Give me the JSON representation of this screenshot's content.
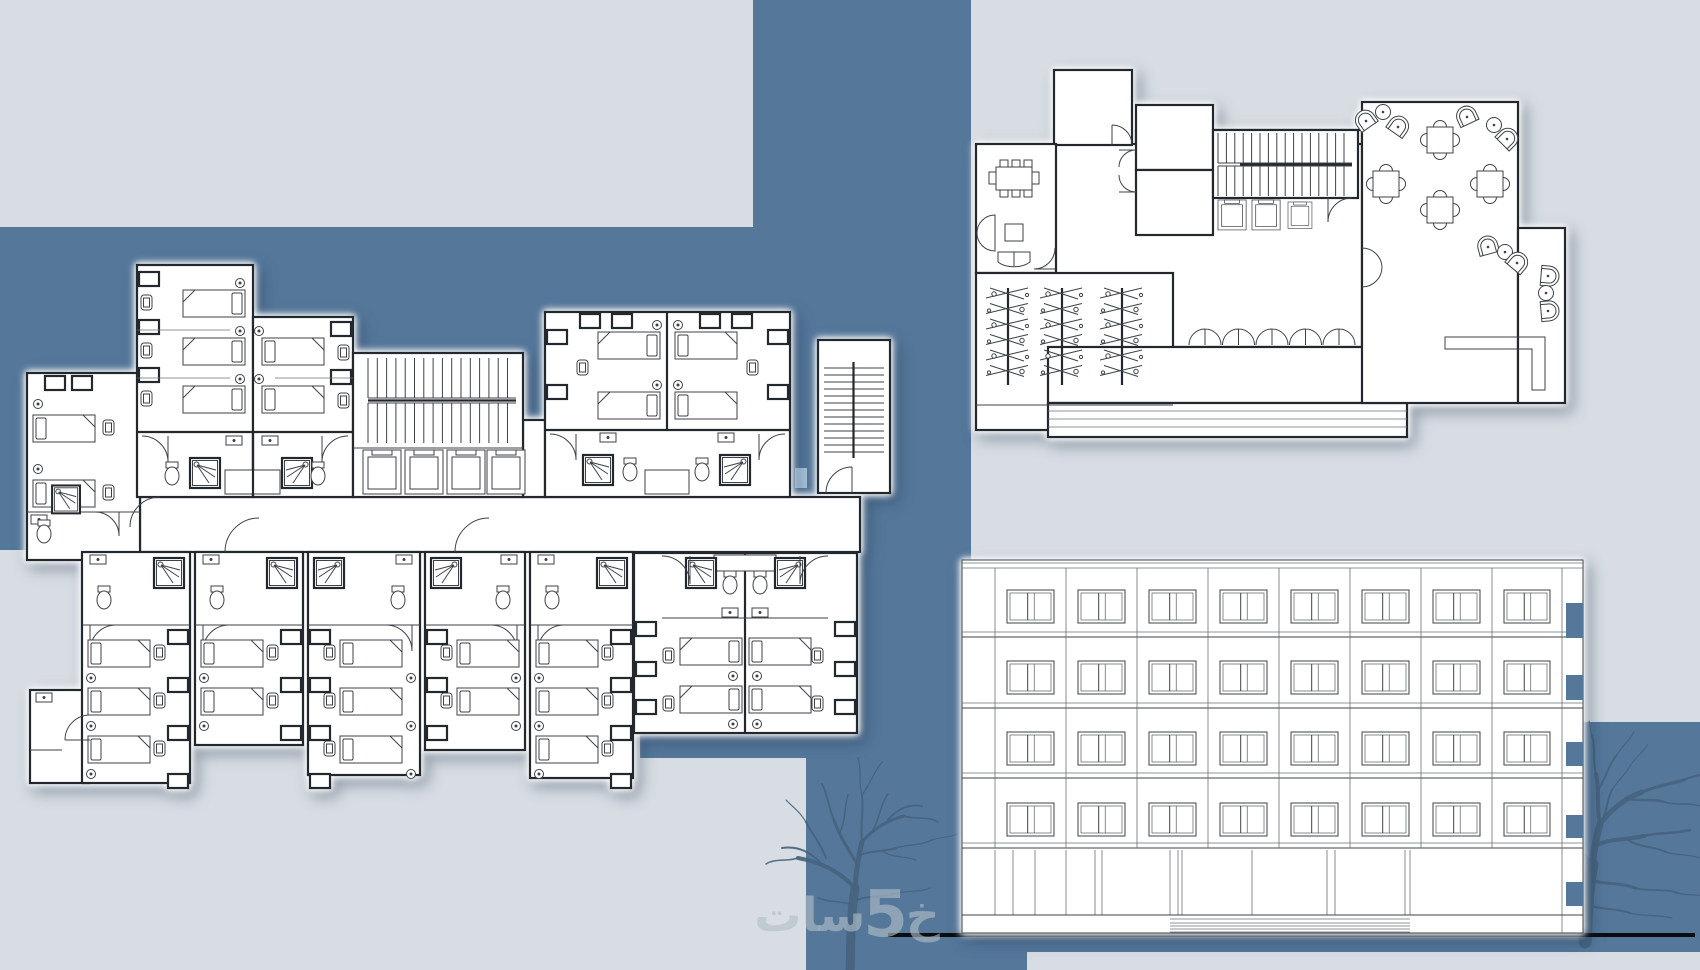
{
  "canvas": {
    "width": 1700,
    "height": 970
  },
  "colors": {
    "background_dark": "#54779A",
    "panel_light": "#D7DDE3",
    "accent_patch": "#A9C7DC",
    "paper_white": "#FFFFFF",
    "line_dark": "#3C4248",
    "wall_dark": "#23282E",
    "tree_silhouette": "#47637E",
    "ground_line": "#0B0C0D",
    "watermark_text": "rgba(178,190,199,0.62)"
  },
  "watermark": {
    "prefix": "خ",
    "digit": "5",
    "suffix": "سات"
  },
  "background": {
    "light_rects": [
      {
        "x": 0,
        "y": 0,
        "w": 753,
        "h": 227
      },
      {
        "x": 971,
        "y": 0,
        "w": 729,
        "h": 722
      },
      {
        "x": 0,
        "y": 550,
        "w": 640,
        "h": 420
      },
      {
        "x": 628,
        "y": 758,
        "w": 178,
        "h": 212
      },
      {
        "x": 1027,
        "y": 952,
        "w": 673,
        "h": 18
      }
    ],
    "accent_patch": {
      "x": 795,
      "y": 468,
      "w": 12,
      "h": 20
    },
    "ground_line": {
      "x1": 888,
      "x2": 1695,
      "y": 933,
      "h": 4
    }
  },
  "drawings": {
    "typical_floor_plan": {
      "name": "typical-floor-plan",
      "lower_units": [
        {
          "x": 82,
          "w": 108,
          "bottom": 783,
          "beds": 3,
          "mirror": false
        },
        {
          "x": 195,
          "w": 108,
          "bottom": 745,
          "beds": 2,
          "mirror": false
        },
        {
          "x": 308,
          "w": 112,
          "bottom": 775,
          "beds": 3,
          "mirror": true
        },
        {
          "x": 425,
          "w": 100,
          "bottom": 750,
          "beds": 2,
          "mirror": true
        },
        {
          "x": 530,
          "w": 103,
          "bottom": 778,
          "beds": 3,
          "mirror": false
        }
      ],
      "main_stair": {
        "x1": 368,
        "x2": 516,
        "runs": [
          [
            358,
            398
          ],
          [
            403,
            443
          ]
        ],
        "step": 9.3,
        "rail_y": 400.5
      },
      "tower_stair": {
        "x1": 824,
        "x2": 884,
        "y1": 368,
        "y2": 458,
        "step": 7,
        "rail_x": 853.5
      }
    },
    "ground_floor_plan": {
      "name": "ground-floor-plan",
      "lobby_stair": {
        "x1": 1218,
        "x2": 1352,
        "runs": [
          [
            133,
            163
          ],
          [
            166,
            196
          ]
        ],
        "step": 8.4,
        "rail_y": 164.5,
        "rail_x1": 1240
      },
      "plants": {
        "columns": [
          1008,
          1062,
          1122
        ],
        "top": 292,
        "rows": 6,
        "dy": 15.5
      },
      "colonnade": {
        "x0": 1189,
        "count": 5,
        "pitch": 33.5,
        "y": 345,
        "r": 16
      },
      "restaurant_tables": [
        [
          1440,
          140
        ],
        [
          1386,
          184
        ],
        [
          1490,
          184
        ],
        [
          1440,
          210
        ]
      ],
      "lounge_clusters": [
        {
          "items": [
            {
              "t": "chair",
              "x": 1366,
              "y": 121,
              "r": -35
            },
            {
              "t": "table",
              "x": 1383,
              "y": 112
            },
            {
              "t": "chair",
              "x": 1398,
              "y": 127,
              "r": 35
            }
          ]
        },
        {
          "items": [
            {
              "t": "chair",
              "x": 1467,
              "y": 117,
              "r": -25
            },
            {
              "t": "table",
              "x": 1494,
              "y": 125
            },
            {
              "t": "chair",
              "x": 1507,
              "y": 139,
              "r": 45
            }
          ]
        },
        {
          "items": [
            {
              "t": "chair",
              "x": 1488,
              "y": 247,
              "r": -15
            },
            {
              "t": "table",
              "x": 1505,
              "y": 252
            },
            {
              "t": "chair",
              "x": 1517,
              "y": 263,
              "r": 40
            }
          ]
        },
        {
          "items": [
            {
              "t": "chair",
              "x": 1548,
              "y": 276,
              "r": 95
            },
            {
              "t": "table",
              "x": 1546,
              "y": 293
            },
            {
              "t": "chair",
              "x": 1548,
              "y": 311,
              "r": 85
            }
          ]
        }
      ]
    },
    "front_elevation": {
      "name": "front-elevation",
      "x": 962,
      "right": 1583,
      "top": 560,
      "bottom": 933,
      "bays": [
        962,
        995,
        1066,
        1137,
        1208,
        1279,
        1350,
        1421,
        1492,
        1562
      ],
      "floors": 4,
      "windows_per_floor": 8,
      "window_rows": [
        590,
        661,
        732,
        803
      ],
      "window_height": 33,
      "window_margin": 12,
      "floor_lines": [
        637,
        708,
        778,
        848
      ],
      "top_band": [
        563,
        568
      ],
      "ground_top": 850,
      "base_line": 915,
      "ground_mullions": [
        995,
        1013,
        1035,
        1066,
        1095,
        1102,
        1170,
        1178,
        1182,
        1252,
        1327,
        1335,
        1405,
        1410
      ],
      "steps": {
        "x1": 1170,
        "x2": 1410,
        "ys": [
          919,
          923,
          926,
          929,
          932
        ]
      },
      "notch_x": 1566,
      "notch_w": 17,
      "notches": [
        {
          "y": 603,
          "h": 35
        },
        {
          "y": 675,
          "h": 25
        },
        {
          "y": 742,
          "h": 24
        },
        {
          "y": 815,
          "h": 23
        },
        {
          "y": 882,
          "h": 24
        }
      ]
    }
  }
}
